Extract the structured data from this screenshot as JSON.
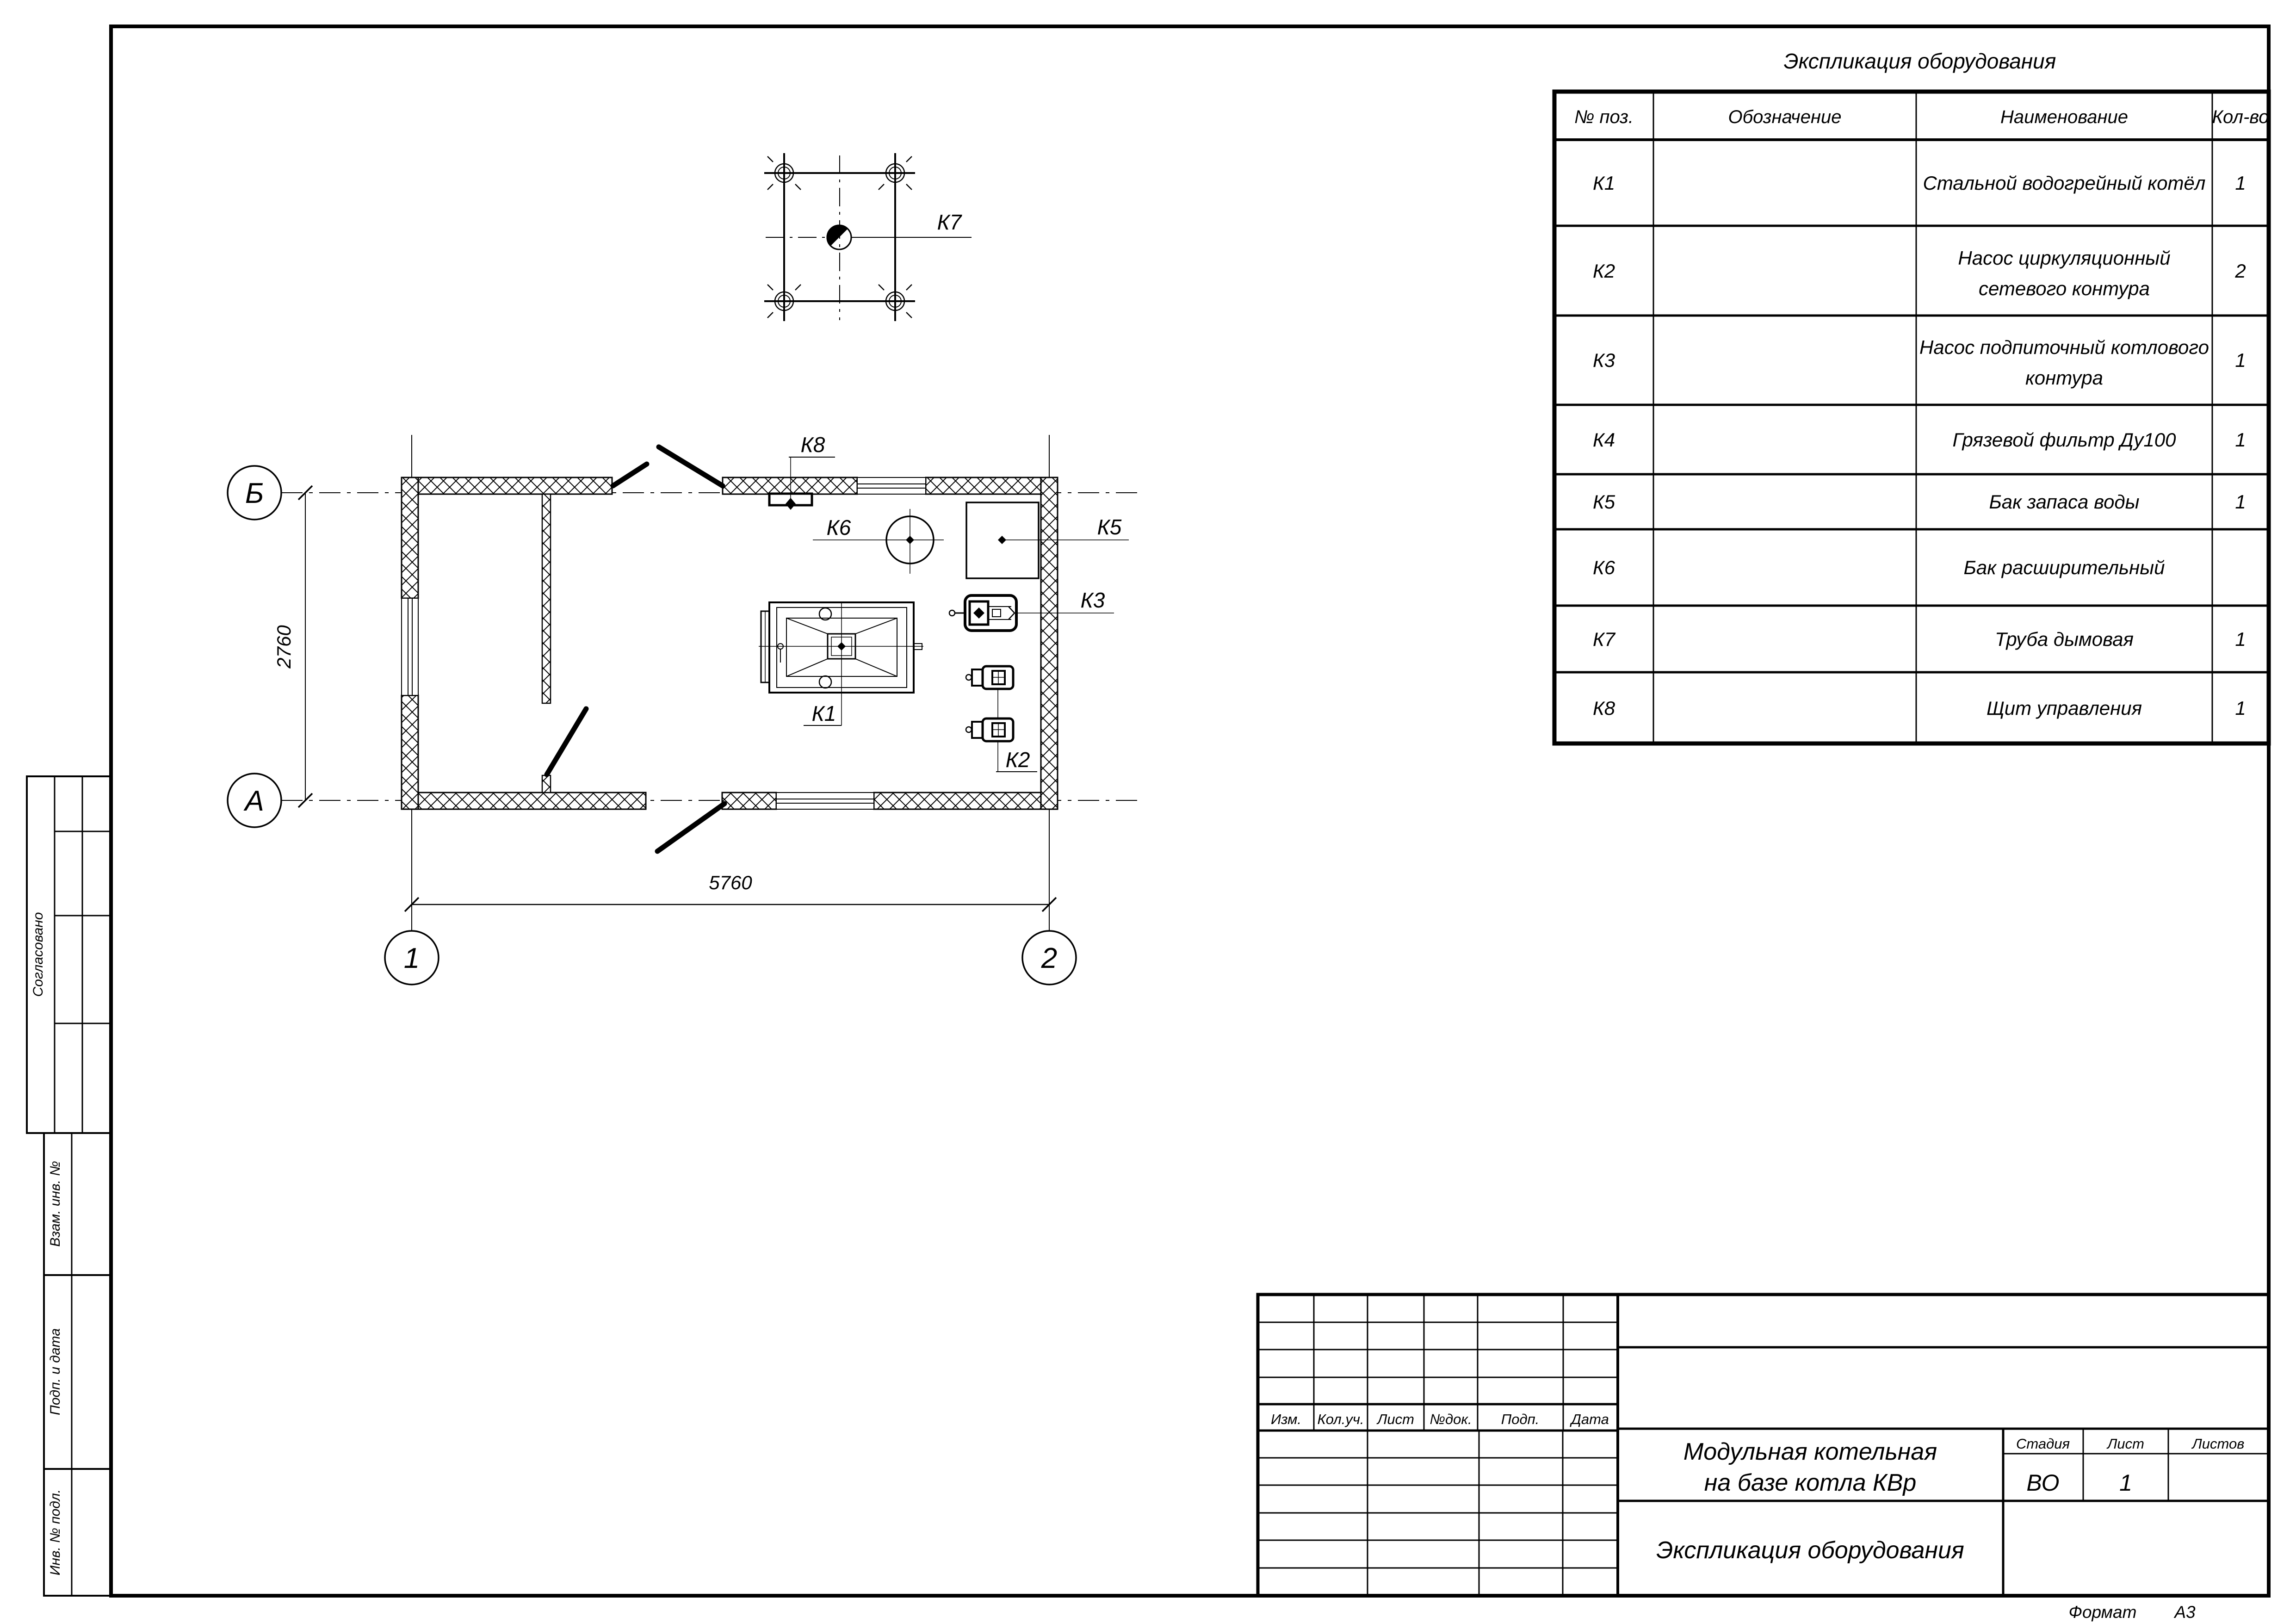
{
  "colors": {
    "ink": "#000000",
    "paper": "#ffffff"
  },
  "plan": {
    "axis_marks": {
      "top_left": "Б",
      "bottom_left": "А",
      "col1": "1",
      "col2": "2"
    },
    "dimensions": {
      "vertical": "2760",
      "horizontal": "5760"
    },
    "tags": {
      "k1": "К1",
      "k2": "К2",
      "k3": "К3",
      "k5": "К5",
      "k6": "К6",
      "k7": "К7",
      "k8": "К8"
    }
  },
  "equipment_table": {
    "title": "Экспликация оборудования",
    "headers": {
      "pos": "№ поз.",
      "designation": "Обозначение",
      "name": "Наименование",
      "qty": "Кол-во"
    },
    "rows": [
      {
        "pos": "К1",
        "designation": "",
        "qty": "1",
        "name_lines": [
          "Стальной водогрейный котёл"
        ]
      },
      {
        "pos": "К2",
        "designation": "",
        "qty": "2",
        "name_lines": [
          "Насос циркуляционный",
          "сетевого контура"
        ]
      },
      {
        "pos": "К3",
        "designation": "",
        "qty": "1",
        "name_lines": [
          "Насос подпиточный котлового",
          "контура"
        ]
      },
      {
        "pos": "К4",
        "designation": "",
        "qty": "1",
        "name_lines": [
          "Грязевой фильтр Ду100"
        ]
      },
      {
        "pos": "К5",
        "designation": "",
        "qty": "1",
        "name_lines": [
          "Бак запаса воды"
        ]
      },
      {
        "pos": "К6",
        "designation": "",
        "qty": "",
        "name_lines": [
          "Бак расширительный"
        ]
      },
      {
        "pos": "К7",
        "designation": "",
        "qty": "1",
        "name_lines": [
          "Труба дымовая"
        ]
      },
      {
        "pos": "К8",
        "designation": "",
        "qty": "1",
        "name_lines": [
          "Щит управления"
        ]
      }
    ]
  },
  "title_block": {
    "revision_headers": {
      "izm": "Изм.",
      "koluch": "Кол.уч.",
      "list": "Лист",
      "ndok": "№док.",
      "podp": "Подп.",
      "data": "Дата"
    },
    "project_name_line1": "Модульная котельная",
    "project_name_line2": "на базе котла КВр",
    "doc_name": "Экспликация оборудования",
    "stage_label": "Стадия",
    "sheet_label": "Лист",
    "sheets_label": "Листов",
    "stage_value": "ВО",
    "sheet_value": "1",
    "sheets_value": "",
    "format_label": "Формат",
    "format_value": "А3"
  },
  "side_stamp": {
    "approved": "Согласовано",
    "replace_inv": "Взам. инв. №",
    "sign_date": "Подп. и дата",
    "inv_number": "Инв. № подл."
  }
}
